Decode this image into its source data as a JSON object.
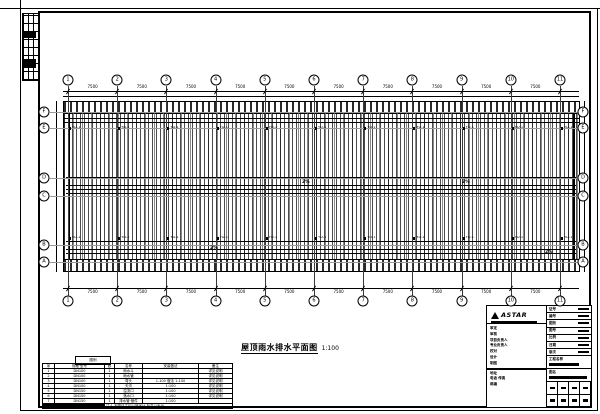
{
  "sheet": {
    "background": "#ffffff",
    "line_color": "#000000"
  },
  "grid": {
    "top_numbers": [
      "1",
      "2",
      "3",
      "4",
      "5",
      "6",
      "7",
      "8",
      "9",
      "10",
      "11"
    ],
    "bottom_numbers": [
      "1",
      "2",
      "3",
      "4",
      "5",
      "6",
      "7",
      "8",
      "9",
      "10",
      "11"
    ],
    "left_letters": [
      "F",
      "E",
      "D",
      "C",
      "B",
      "A"
    ],
    "right_letters": [
      "F",
      "E",
      "D",
      "C",
      "B",
      "A"
    ]
  },
  "dimensions": {
    "top": [
      "7500",
      "7500",
      "7500",
      "7500",
      "7500",
      "7500",
      "7500",
      "7500",
      "7500",
      "7500"
    ],
    "bottom": [
      "7500",
      "7500",
      "7500",
      "7500",
      "7500",
      "7500",
      "7500",
      "7500",
      "7500",
      "7500"
    ]
  },
  "plan": {
    "drain_label": "YD-1",
    "slope_label": "2%"
  },
  "drawing_title": {
    "text": "屋顶雨水排水平面图",
    "scale": "1:100"
  },
  "legend_table": {
    "caption": "图例",
    "headers": [
      "序",
      "规格·型号",
      "数",
      "名称",
      "安装做法",
      "备注"
    ],
    "rows": [
      [
        "1",
        "DN100",
        "1",
        "雨水斗",
        "",
        "详见说明"
      ],
      [
        "2",
        "DN100",
        "1",
        "雨水管",
        "",
        "详见说明"
      ],
      [
        "3",
        "DN100",
        "1",
        "弯头",
        "1-100 做法 1-100",
        "详见说明"
      ],
      [
        "4",
        "DN100",
        "1",
        "天沟",
        "1:100",
        "详见说明"
      ],
      [
        "5",
        "DN150",
        "1",
        "溢流口",
        "1:100",
        "详见说明"
      ],
      [
        "6",
        "DN150",
        "1",
        "落水口",
        "1:100",
        "详见说明"
      ],
      [
        "7",
        "DN150",
        "1",
        "排水管·管件",
        "1:100",
        ""
      ]
    ],
    "note": "注:1 本图尺寸均以毫米计,标高以米计。"
  },
  "titleblock": {
    "logo_text": "ASTAR",
    "left_rows": [
      "审定",
      "审核",
      "项目负责人",
      "专业负责人",
      "校对",
      "设计",
      "制图"
    ],
    "address_rows": [
      "地址",
      "电话 传真",
      "邮编"
    ],
    "right_rows": [
      {
        "label": "证号"
      },
      {
        "label": "编号"
      },
      {
        "label": "图别"
      },
      {
        "label": "图号"
      },
      {
        "label": "比例"
      },
      {
        "label": "日期"
      },
      {
        "label": "版次"
      }
    ],
    "project_label": "工程名称",
    "sheet_label": "图名"
  }
}
